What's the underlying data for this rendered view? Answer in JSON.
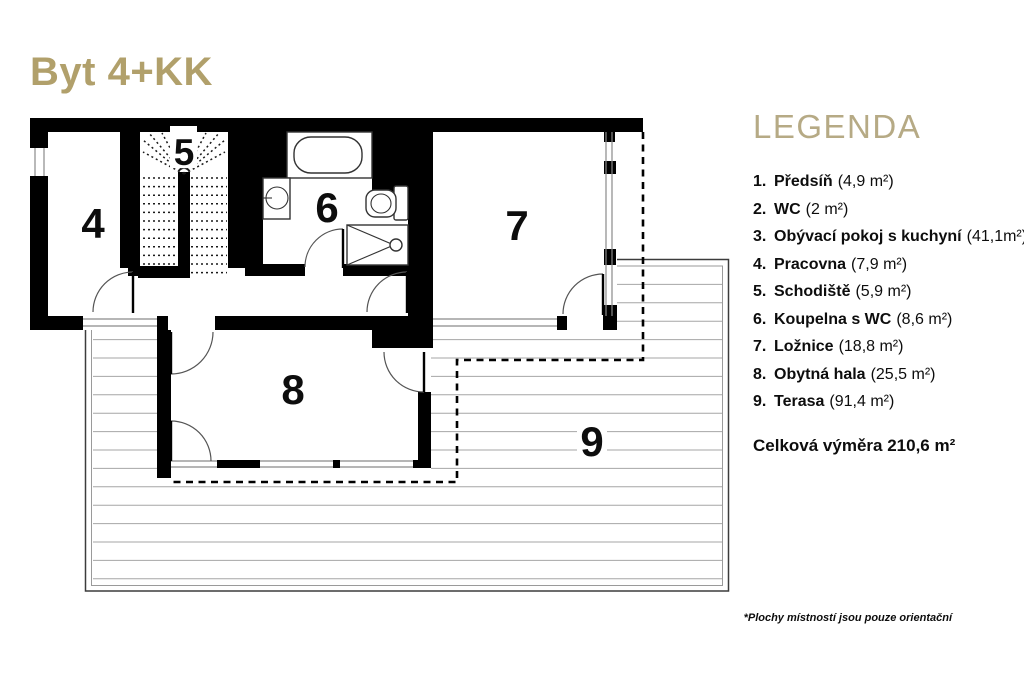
{
  "title": "Byt 4+KK",
  "legend": {
    "heading": "LEGENDA",
    "items": [
      {
        "num": "1.",
        "name": "Předsíň",
        "area": "(4,9 m²)"
      },
      {
        "num": "2.",
        "name": "WC",
        "area": "(2 m²)"
      },
      {
        "num": "3.",
        "name": "Obývací pokoj s kuchyní",
        "area": "(41,1m²)"
      },
      {
        "num": "4.",
        "name": "Pracovna",
        "area": "(7,9 m²)"
      },
      {
        "num": "5.",
        "name": "Schodiště",
        "area": "(5,9 m²)"
      },
      {
        "num": "6.",
        "name": "Koupelna s WC",
        "area": "(8,6 m²)"
      },
      {
        "num": "7.",
        "name": "Ložnice",
        "area": "(18,8 m²)"
      },
      {
        "num": "8.",
        "name": "Obytná hala",
        "area": "(25,5 m²)"
      },
      {
        "num": "9.",
        "name": "Terasa",
        "area": "(91,4 m²)"
      }
    ],
    "total": "Celková výměra 210,6 m²"
  },
  "plan": {
    "room_numbers": [
      "4",
      "5",
      "6",
      "7",
      "8",
      "9"
    ]
  },
  "footnote": "*Plochy místností jsou pouze orientační",
  "colors": {
    "accent": "#b1a06b",
    "legend_heading": "#b6aa85",
    "wall": "#000000",
    "deck_line": "#a6a6a6"
  }
}
